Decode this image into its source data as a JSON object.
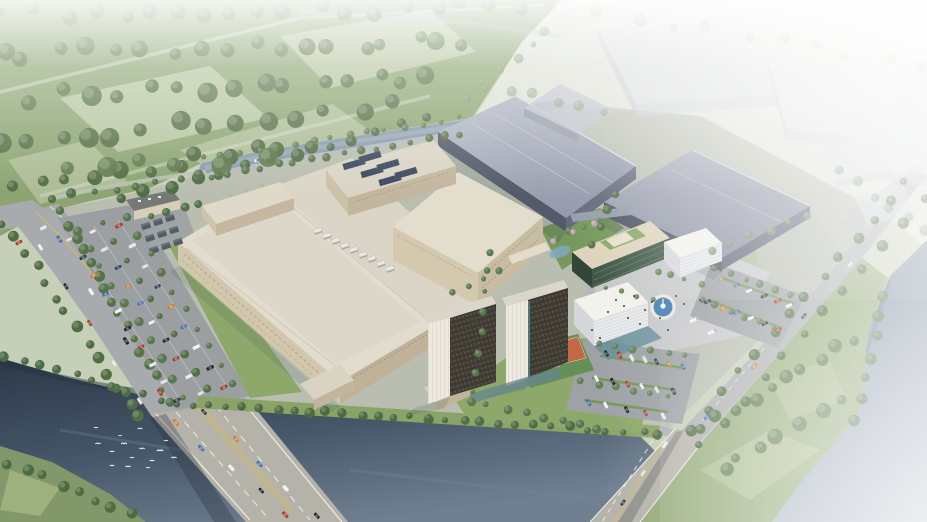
{
  "meta": {
    "title": "Aerial 3D architectural rendering of a riverside industrial campus",
    "view": "isometric aerial",
    "no_visible_text": true
  },
  "palette": {
    "haze": "#ffffff",
    "forest": "#86a06a",
    "field_light": "#b7c6a0",
    "ne_field": "#dadfd1",
    "campus_ground": "#b6bbac",
    "lawn": "#84a05e",
    "asphalt": "#a4a7aa",
    "bridge_deck": "#b2afa5",
    "parking": "#999da1",
    "plaza": "#c5c6c8",
    "river_dark": "#24334a",
    "river_light": "#5f7084",
    "canal": "#8496a6",
    "right_water": "#7b8da2",
    "factory_roof": "#e0dbcc",
    "factory_wall": "#d0c4a9",
    "factory_wall_shadow": "#bcae93",
    "slate_roof": "#a6acba",
    "slate_wall": "#4a5262",
    "tower_dark": "#35312a",
    "tower_white": "#ece8de",
    "office_glass": "#37503f",
    "cube_white": "#f2f1ea",
    "court_orange": "#c2603f",
    "court_green": "#5d8a4f",
    "fountain_water": "#3c7cad",
    "tree_green": "#4a6a3c",
    "road_yellow": "#d7b84e",
    "solar_panel": "#2c3850"
  },
  "scatter": {
    "car_colors": [
      "#f0f0ee",
      "#223148",
      "#a03327",
      "#3c67ab",
      "#d9d9d7",
      "#17181c",
      "#c97c2e",
      "#e6e7e9"
    ],
    "tree_rows": [
      {
        "from": [
          8,
          14
        ],
        "to": [
          545,
          6
        ],
        "n": 20,
        "r": 7,
        "c": "#5d7b4a",
        "j": 9,
        "o": 0.95
      },
      {
        "from": [
          0,
          54
        ],
        "to": [
          470,
          40
        ],
        "n": 18,
        "r": 7.5,
        "c": "#56743f",
        "j": 10
      },
      {
        "from": [
          0,
          98
        ],
        "to": [
          435,
          78
        ],
        "n": 16,
        "r": 8,
        "c": "#52703e",
        "j": 10
      },
      {
        "from": [
          0,
          144
        ],
        "to": [
          385,
          106
        ],
        "n": 14,
        "r": 8,
        "c": "#4d6a3b",
        "j": 10
      },
      {
        "from": [
          18,
          188
        ],
        "to": [
          305,
          142
        ],
        "n": 12,
        "r": 7,
        "c": "#4a673a",
        "j": 8
      },
      {
        "from": [
          120,
          200
        ],
        "to": [
          430,
          118
        ],
        "n": 13,
        "r": 5.5,
        "c": "#47663c",
        "j": 5
      },
      {
        "from": [
          60,
          170
        ],
        "to": [
          260,
          160
        ],
        "n": 6,
        "r": 9,
        "c": "#55723f",
        "j": 10,
        "o": 0.9
      },
      {
        "from": [
          600,
          12
        ],
        "to": [
          920,
          64
        ],
        "n": 10,
        "r": 5,
        "c": "#8aa274",
        "j": 8,
        "o": 0.5
      },
      {
        "from": [
          486,
          82
        ],
        "to": [
          600,
          116
        ],
        "n": 6,
        "r": 5,
        "c": "#7f9a6c",
        "j": 6,
        "o": 0.6
      },
      {
        "from": [
          842,
          170
        ],
        "to": [
          925,
          232
        ],
        "n": 6,
        "r": 5,
        "c": "#6d8a5c",
        "j": 5,
        "o": 0.7
      },
      {
        "from": [
          470,
          100
        ],
        "to": [
          545,
          32
        ],
        "n": 6,
        "r": 4,
        "c": "#7d9768",
        "j": 4,
        "o": 0.75
      },
      {
        "from": [
          4,
          222
        ],
        "to": [
          140,
          418
        ],
        "n": 14,
        "r": 5,
        "c": "#47663a",
        "j": 4
      },
      {
        "from": [
          62,
          212
        ],
        "to": [
          170,
          402
        ],
        "n": 16,
        "r": 4.5,
        "c": "#4d6c3e",
        "j": 3
      },
      {
        "from": [
          78,
          230
        ],
        "to": [
          184,
          396
        ],
        "n": 10,
        "r": 3.8,
        "c": "#527044",
        "j": 2.5
      },
      {
        "from": [
          102,
          224
        ],
        "to": [
          208,
          390
        ],
        "n": 10,
        "r": 3.6,
        "c": "#4a683c",
        "j": 2.5
      },
      {
        "from": [
          126,
          218
        ],
        "to": [
          232,
          384
        ],
        "n": 10,
        "r": 3.6,
        "c": "#507044",
        "j": 2.5
      },
      {
        "from": [
          176,
          404
        ],
        "to": [
          428,
          418
        ],
        "n": 16,
        "r": 4.4,
        "c": "#43623a",
        "j": 3
      },
      {
        "from": [
          428,
          418
        ],
        "to": [
          660,
          434
        ],
        "n": 14,
        "r": 4.2,
        "c": "#47663c",
        "j": 3
      },
      {
        "from": [
          210,
          176
        ],
        "to": [
          462,
          134
        ],
        "n": 16,
        "r": 3.4,
        "c": "#4f6e41",
        "j": 2.5
      },
      {
        "from": [
          204,
          158
        ],
        "to": [
          458,
          118
        ],
        "n": 15,
        "r": 3,
        "c": "#597946",
        "j": 2.5
      },
      {
        "from": [
          150,
          216
        ],
        "to": [
          200,
          204
        ],
        "n": 4,
        "r": 3.6,
        "c": "#4c6a3e",
        "j": 2
      },
      {
        "from": [
          906,
          180
        ],
        "to": [
          690,
          430
        ],
        "n": 14,
        "r": 4.5,
        "c": "#4b6a3e",
        "j": 3
      },
      {
        "from": [
          925,
          200
        ],
        "to": [
          702,
          446
        ],
        "n": 12,
        "r": 5,
        "c": "#466539",
        "j": 3.5
      },
      {
        "from": [
          702,
          428
        ],
        "to": [
          854,
          338
        ],
        "n": 10,
        "r": 6,
        "c": "#4c6e3e",
        "j": 5
      },
      {
        "from": [
          722,
          470
        ],
        "to": [
          838,
          402
        ],
        "n": 7,
        "r": 6.5,
        "c": "#547547",
        "j": 6
      },
      {
        "from": [
          884,
          298
        ],
        "to": [
          858,
          418
        ],
        "n": 7,
        "r": 5,
        "c": "#4e7040",
        "j": 4
      },
      {
        "from": [
          10,
          462
        ],
        "to": [
          130,
          514
        ],
        "n": 8,
        "r": 5.5,
        "c": "#456538",
        "j": 4
      },
      {
        "from": [
          6,
          356
        ],
        "to": [
          162,
          400
        ],
        "n": 10,
        "r": 4.4,
        "c": "#44643a",
        "j": 3
      },
      {
        "from": [
          556,
          238
        ],
        "to": [
          600,
          220
        ],
        "n": 4,
        "r": 3.2,
        "c": "#5a7d4a",
        "j": 2
      },
      {
        "from": [
          470,
          402
        ],
        "to": [
          598,
          428
        ],
        "n": 8,
        "r": 3.6,
        "c": "#507046",
        "j": 3
      },
      {
        "from": [
          716,
          268
        ],
        "to": [
          790,
          296
        ],
        "n": 6,
        "r": 3.2,
        "c": "#55744a",
        "j": 2
      },
      {
        "from": [
          702,
          300
        ],
        "to": [
          774,
          328
        ],
        "n": 6,
        "r": 3.2,
        "c": "#55744a",
        "j": 2
      },
      {
        "from": [
          598,
          344
        ],
        "to": [
          686,
          356
        ],
        "n": 6,
        "r": 3.2,
        "c": "#5a7a4e",
        "j": 2
      },
      {
        "from": [
          582,
          382
        ],
        "to": [
          668,
          396
        ],
        "n": 6,
        "r": 3.2,
        "c": "#5a7a4e",
        "j": 2
      },
      {
        "from": [
          492,
          252
        ],
        "to": [
          474,
          392
        ],
        "n": 8,
        "r": 3.4,
        "c": "#507044",
        "j": 2.5
      },
      {
        "from": [
          710,
          250
        ],
        "to": [
          810,
          216
        ],
        "n": 6,
        "r": 3.8,
        "c": "#6d8a5a",
        "j": 3,
        "o": 0.8
      },
      {
        "from": [
          614,
          194
        ],
        "to": [
          592,
          244
        ],
        "n": 4,
        "r": 3.8,
        "c": "#4e6c40",
        "j": 2
      },
      {
        "from": [
          552,
          240
        ],
        "to": [
          596,
          222
        ],
        "n": 3,
        "r": 3,
        "c": "#c69ab2",
        "j": 2
      },
      {
        "from": [
          604,
          288
        ],
        "to": [
          652,
          300
        ],
        "n": 4,
        "r": 2.8,
        "c": "#5a7d4a",
        "j": 2
      },
      {
        "from": [
          658,
          272
        ],
        "to": [
          700,
          284
        ],
        "n": 4,
        "r": 2.8,
        "c": "#5a7d4a",
        "j": 2
      },
      {
        "from": [
          452,
          292
        ],
        "to": [
          500,
          272
        ],
        "n": 4,
        "r": 3,
        "c": "#54734a",
        "j": 2
      },
      {
        "from": [
          50,
          198
        ],
        "to": [
          200,
          176
        ],
        "n": 8,
        "r": 4,
        "c": "#4c6a3e",
        "j": 3
      }
    ],
    "car_rows": [
      {
        "from": [
          40,
          248
        ],
        "to": [
          140,
          400
        ],
        "n": 5,
        "a": 58,
        "j": 2
      },
      {
        "from": [
          58,
          240
        ],
        "to": [
          158,
          392
        ],
        "n": 4,
        "a": 58,
        "j": 2
      },
      {
        "from": [
          176,
          424
        ],
        "to": [
          288,
          514
        ],
        "n": 5,
        "a": 48,
        "j": 3
      },
      {
        "from": [
          206,
          412
        ],
        "to": [
          316,
          516
        ],
        "n": 5,
        "a": 48,
        "j": 3
      },
      {
        "from": [
          70,
          240
        ],
        "to": [
          176,
          400
        ],
        "n": 10,
        "a": -26,
        "j": 1.5
      },
      {
        "from": [
          94,
          232
        ],
        "to": [
          200,
          394
        ],
        "n": 10,
        "a": -26,
        "j": 1.5
      },
      {
        "from": [
          118,
          226
        ],
        "to": [
          224,
          388
        ],
        "n": 9,
        "a": -26,
        "j": 1.5
      },
      {
        "from": [
          606,
          354
        ],
        "to": [
          682,
          366
        ],
        "n": 7,
        "a": 62,
        "j": 1.5
      },
      {
        "from": [
          596,
          378
        ],
        "to": [
          672,
          392
        ],
        "n": 6,
        "a": 62,
        "j": 1.5
      },
      {
        "from": [
          588,
          402
        ],
        "to": [
          664,
          416
        ],
        "n": 5,
        "a": 62,
        "j": 1.5
      },
      {
        "from": [
          722,
          280
        ],
        "to": [
          790,
          306
        ],
        "n": 6,
        "a": -24,
        "j": 1.5
      },
      {
        "from": [
          708,
          302
        ],
        "to": [
          778,
          330
        ],
        "n": 6,
        "a": -24,
        "j": 1.5
      },
      {
        "from": [
          852,
          264
        ],
        "to": [
          706,
          418
        ],
        "n": 4,
        "a": 132,
        "j": 2
      },
      {
        "from": [
          664,
          446
        ],
        "to": [
          622,
          502
        ],
        "n": 3,
        "a": 126,
        "j": 2
      },
      {
        "from": [
          18,
          242
        ],
        "to": [
          44,
          228
        ],
        "n": 2,
        "a": -28,
        "j": 1
      }
    ],
    "point_sets": [
      {
        "sym": "#hvac",
        "layer": "layer-details",
        "pts": [
          [
            318,
            231
          ],
          [
            327,
            236
          ],
          [
            336,
            241
          ],
          [
            345,
            246
          ],
          [
            354,
            250
          ],
          [
            363,
            255
          ],
          [
            372,
            259
          ],
          [
            381,
            264
          ],
          [
            390,
            269
          ]
        ]
      },
      {
        "sym": "#solar",
        "layer": "layer-details",
        "pts": [
          [
            354,
            164
          ],
          [
            372,
            172
          ],
          [
            390,
            180
          ],
          [
            370,
            157
          ],
          [
            388,
            165
          ],
          [
            406,
            173
          ]
        ]
      },
      {
        "sym": "#substat",
        "layer": "layer-details",
        "pts": [
          [
            146,
            226
          ],
          [
            158,
            222
          ],
          [
            170,
            218
          ],
          [
            150,
            238
          ],
          [
            162,
            234
          ],
          [
            174,
            230
          ],
          [
            154,
            250
          ],
          [
            166,
            246
          ],
          [
            178,
            242
          ]
        ]
      },
      {
        "sym": "#truck",
        "layer": "layer-vehicles",
        "a": -24,
        "pts": [
          [
            694,
            320
          ],
          [
            712,
            332
          ]
        ]
      },
      {
        "sym": "#boat",
        "layer": "layer-details",
        "a": -17,
        "pts": [
          [
            258,
            160
          ]
        ]
      },
      {
        "sym": "#person",
        "layer": "layer-people",
        "c": "#2c2c2c",
        "pts": [
          [
            616,
            300
          ],
          [
            624,
            306
          ],
          [
            634,
            296
          ],
          [
            645,
            310
          ],
          [
            652,
            302
          ],
          [
            660,
            318
          ],
          [
            640,
            324
          ],
          [
            628,
            318
          ],
          [
            676,
            296
          ],
          [
            684,
            304
          ],
          [
            700,
            300
          ],
          [
            668,
            330
          ],
          [
            608,
            312
          ],
          [
            592,
            330
          ],
          [
            600,
            338
          ]
        ]
      },
      {
        "sym": "#bird",
        "layer": "layer-birds",
        "pts": [
          [
            98,
            444,
            1
          ],
          [
            112,
            452,
            0.9
          ],
          [
            124,
            444,
            1.1
          ],
          [
            132,
            458,
            0.8
          ],
          [
            142,
            449,
            1
          ],
          [
            152,
            461,
            0.9
          ],
          [
            160,
            451,
            1.2
          ],
          [
            148,
            468,
            0.8
          ],
          [
            128,
            467,
            1
          ],
          [
            112,
            466,
            0.9
          ],
          [
            166,
            441,
            0.8
          ],
          [
            174,
            458,
            1
          ],
          [
            96,
            428,
            0.8
          ],
          [
            140,
            429,
            0.9
          ],
          [
            120,
            436,
            0.7
          ]
        ]
      }
    ]
  }
}
